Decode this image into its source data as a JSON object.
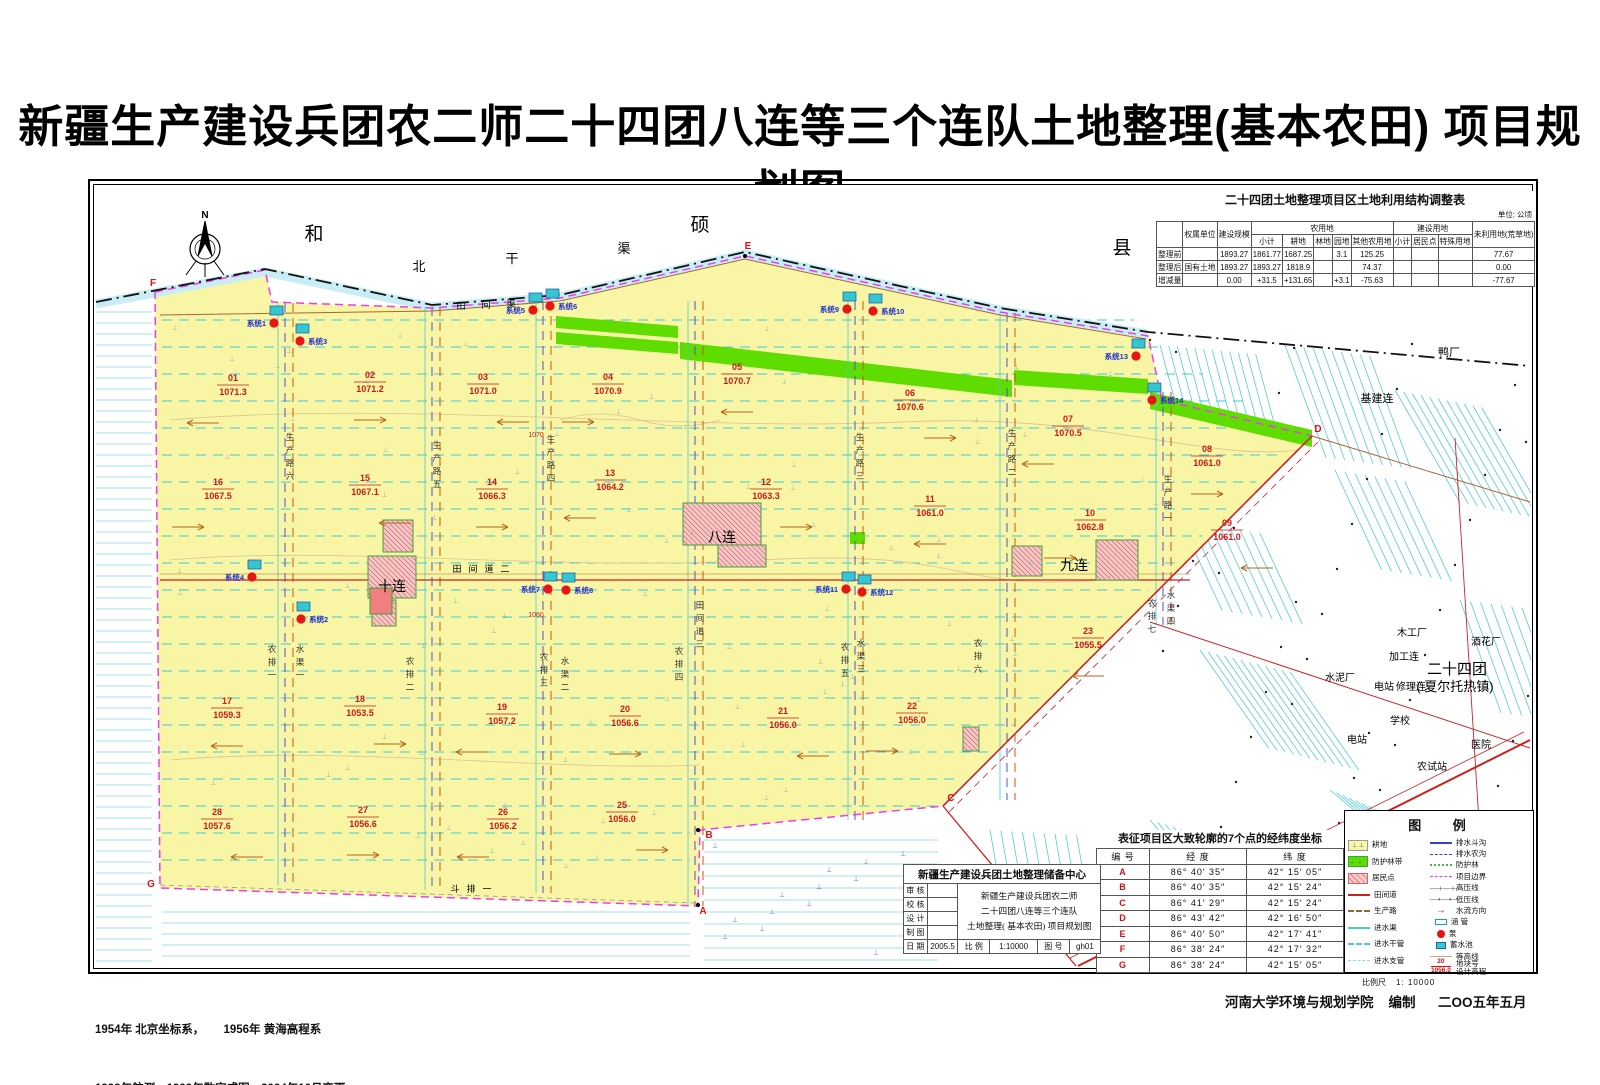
{
  "title": "新疆生产建设兵团农二师二十四团八连等三个连队土地整理(基本农田) 项目规划图",
  "adjustment_table": {
    "title": "二十四团土地整理项目区土地利用结构调整表",
    "unit": "单位: 公顷",
    "headers": {
      "row_label": "",
      "ownership": "权属单位",
      "scale": "建设规模",
      "agri": "农用地",
      "agri_sub": [
        "小计",
        "耕地",
        "林地",
        "园地",
        "其他农用地"
      ],
      "constr": "建设用地",
      "constr_sub": [
        "小计",
        "居民点",
        "特殊用地"
      ],
      "unused": "未利用地(荒草地)"
    },
    "rows": [
      {
        "label": "整理前",
        "ownership": "",
        "scale": "1893.27",
        "cells": [
          "1861.77",
          "1687.25",
          "",
          "3.1",
          "125.25",
          "",
          "",
          "",
          "77.67"
        ]
      },
      {
        "label": "整理后",
        "ownership": "国有土地",
        "scale": "1893.27",
        "cells": [
          "1893.27",
          "1818.9",
          "",
          "",
          "74.37",
          "",
          "",
          "",
          "0.00"
        ]
      },
      {
        "label": "增减量",
        "ownership": "",
        "scale": "0.00",
        "cells": [
          "+31.5",
          "+131.65",
          "",
          "+3.1",
          "-75.63",
          "",
          "",
          "",
          "-77.67"
        ]
      }
    ]
  },
  "coord_table": {
    "title": "表征项目区大致轮廓的7个点的经纬度坐标",
    "headers": [
      "编 号",
      "经 度",
      "纬 度"
    ],
    "rows": [
      [
        "A",
        "86° 40′ 35″",
        "42° 15′ 05″"
      ],
      [
        "B",
        "86° 40′ 35″",
        "42° 15′ 24″"
      ],
      [
        "C",
        "86° 41′ 29″",
        "42° 15′ 24″"
      ],
      [
        "D",
        "86° 43′ 42″",
        "42° 16′ 50″"
      ],
      [
        "E",
        "86° 40′ 50″",
        "42° 17′ 41″"
      ],
      [
        "F",
        "86° 38′ 24″",
        "42° 17′ 32″"
      ],
      [
        "G",
        "86° 38′ 24″",
        "42° 15′ 05″"
      ]
    ]
  },
  "title_block": {
    "org": "新疆生产建设兵团土地整理储备中心",
    "fields": [
      "审 核",
      "校 核",
      "设 计",
      "制 图"
    ],
    "date_label": "日 期",
    "date": "2005.5",
    "project": "新疆生产建设兵团农二师\n二十四团八连等三个连队\n土地整理( 基本农田) 项目规划图",
    "scale_label": "比 例",
    "scale": "1:10000",
    "fig_label": "图 号",
    "fig_no": "gh01"
  },
  "legend": {
    "title": "图 例",
    "left": [
      {
        "sym": "plot",
        "marks": "⊥ ⊥",
        "label": "耕地"
      },
      {
        "sym": "forest",
        "marks": "。 。",
        "label": "防护林带"
      },
      {
        "sym": "res",
        "label": "居民点"
      },
      {
        "sym": "line-red",
        "label": "田间道"
      },
      {
        "sym": "dash-brown",
        "label": "生产路"
      },
      {
        "sym": "line-cyan",
        "label": "进水渠"
      },
      {
        "sym": "dash-cyan",
        "label": "进水干管"
      },
      {
        "sym": "dash-cyan2",
        "label": "进水支管"
      }
    ],
    "right": [
      {
        "sym": "line-blue",
        "label": "排水斗沟"
      },
      {
        "sym": "dash-blue",
        "label": "排水农沟"
      },
      {
        "sym": "dot-green",
        "label": "防护林"
      },
      {
        "sym": "dash-magenta",
        "label": "项目边界"
      },
      {
        "sym": "text",
        "txt": "—+—+—",
        "label": "高压线"
      },
      {
        "sym": "text",
        "txt": "—•—•—",
        "label": "低压线"
      },
      {
        "sym": "arrow",
        "txt": "→",
        "label": "水流方向"
      },
      {
        "sym": "culvert",
        "label": "涵 管"
      },
      {
        "sym": "pump",
        "label": "泵"
      },
      {
        "sym": "pool",
        "label": "蓄水池"
      },
      {
        "sym": "contour",
        "label": "等高线"
      },
      {
        "sym": "plotno",
        "num": "20",
        "den": "1056.0",
        "label": "地块号\n设计高程"
      }
    ],
    "scale_label": "比例尺",
    "scale_value": "1: 10000"
  },
  "footer": {
    "line1": "1954年 北京坐标系，      1956年 黄海高程系",
    "line2": "1998年航测，1999年数字成图，2004年10月变更",
    "credit": "河南大学环境与规划学院    编制      二OO五年五月"
  },
  "map": {
    "compass_label": "N",
    "colors": {
      "plot_fill": "#F8F5A5",
      "forest_green": "#5FDC00",
      "boundary_magenta": "#E93EE9",
      "road_red": "#CC2020",
      "channel_cyan": "#49C9D9",
      "parcel_text_red": "#CC1818",
      "pump_red": "#E81515",
      "pool_cyan": "#35C6CF"
    },
    "parcels": [
      {
        "no": "01",
        "elev": "1071.3",
        "x": 233,
        "y": 383
      },
      {
        "no": "02",
        "elev": "1071.2",
        "x": 370,
        "y": 380
      },
      {
        "no": "03",
        "elev": "1071.0",
        "x": 483,
        "y": 382
      },
      {
        "no": "04",
        "elev": "1070.9",
        "x": 608,
        "y": 382
      },
      {
        "no": "05",
        "elev": "1070.7",
        "x": 737,
        "y": 372
      },
      {
        "no": "06",
        "elev": "1070.6",
        "x": 910,
        "y": 398
      },
      {
        "no": "07",
        "elev": "1070.5",
        "x": 1068,
        "y": 424
      },
      {
        "no": "08",
        "elev": "1061.0",
        "x": 1207,
        "y": 454
      },
      {
        "no": "09",
        "elev": "1061.0",
        "x": 1227,
        "y": 528
      },
      {
        "no": "10",
        "elev": "1062.8",
        "x": 1090,
        "y": 518
      },
      {
        "no": "11",
        "elev": "1061.0",
        "x": 930,
        "y": 504
      },
      {
        "no": "12",
        "elev": "1063.3",
        "x": 766,
        "y": 487
      },
      {
        "no": "13",
        "elev": "1064.2",
        "x": 610,
        "y": 478
      },
      {
        "no": "14",
        "elev": "1066.3",
        "x": 492,
        "y": 487
      },
      {
        "no": "15",
        "elev": "1067.1",
        "x": 365,
        "y": 483
      },
      {
        "no": "16",
        "elev": "1067.5",
        "x": 218,
        "y": 487
      },
      {
        "no": "17",
        "elev": "1059.3",
        "x": 227,
        "y": 706
      },
      {
        "no": "18",
        "elev": "1053.5",
        "x": 360,
        "y": 704
      },
      {
        "no": "19",
        "elev": "1057.2",
        "x": 502,
        "y": 712
      },
      {
        "no": "20",
        "elev": "1056.6",
        "x": 625,
        "y": 714
      },
      {
        "no": "21",
        "elev": "1056.0",
        "x": 783,
        "y": 716
      },
      {
        "no": "22",
        "elev": "1056.0",
        "x": 912,
        "y": 711
      },
      {
        "no": "23",
        "elev": "1055.5",
        "x": 1088,
        "y": 636
      },
      {
        "no": "25",
        "elev": "1056.0",
        "x": 622,
        "y": 810
      },
      {
        "no": "26",
        "elev": "1056.2",
        "x": 503,
        "y": 817
      },
      {
        "no": "27",
        "elev": "1056.6",
        "x": 363,
        "y": 815
      },
      {
        "no": "28",
        "elev": "1057.6",
        "x": 217,
        "y": 817
      }
    ],
    "systems": [
      {
        "label": "系统1",
        "x": 274,
        "y": 323,
        "side": "l"
      },
      {
        "label": "系统3",
        "x": 300,
        "y": 341,
        "side": "r"
      },
      {
        "label": "系统5",
        "x": 533,
        "y": 310,
        "side": "l"
      },
      {
        "label": "系统6",
        "x": 550,
        "y": 306,
        "side": "r"
      },
      {
        "label": "系统9",
        "x": 847,
        "y": 309,
        "side": "l"
      },
      {
        "label": "系统10",
        "x": 873,
        "y": 311,
        "side": "r"
      },
      {
        "label": "系统13",
        "x": 1136,
        "y": 356,
        "side": "l"
      },
      {
        "label": "系统14",
        "x": 1152,
        "y": 400,
        "side": "r"
      },
      {
        "label": "系统4",
        "x": 252,
        "y": 577,
        "side": "l"
      },
      {
        "label": "系统2",
        "x": 301,
        "y": 619,
        "side": "r"
      },
      {
        "label": "系统7",
        "x": 548,
        "y": 589,
        "side": "l"
      },
      {
        "label": "系统8",
        "x": 566,
        "y": 590,
        "side": "r"
      },
      {
        "label": "系统11",
        "x": 846,
        "y": 589,
        "side": "l"
      },
      {
        "label": "系统12",
        "x": 862,
        "y": 592,
        "side": "r"
      }
    ],
    "road_labels": [
      {
        "text": "生产路六",
        "x": 290,
        "y": 440
      },
      {
        "text": "生产路五",
        "x": 437,
        "y": 448
      },
      {
        "text": "生产路四",
        "x": 551,
        "y": 442
      },
      {
        "text": "生产路三",
        "x": 860,
        "y": 440
      },
      {
        "text": "生产路二",
        "x": 1012,
        "y": 436
      },
      {
        "text": "生产路一",
        "x": 1168,
        "y": 482
      },
      {
        "text": "田间道三",
        "x": 700,
        "y": 608
      },
      {
        "text": "农排一",
        "x": 272,
        "y": 652
      },
      {
        "text": "水渠一",
        "x": 300,
        "y": 652
      },
      {
        "text": "农排二",
        "x": 410,
        "y": 664
      },
      {
        "text": "农排三",
        "x": 544,
        "y": 660
      },
      {
        "text": "水渠二",
        "x": 565,
        "y": 664
      },
      {
        "text": "农排四",
        "x": 679,
        "y": 654
      },
      {
        "text": "农排五",
        "x": 845,
        "y": 650
      },
      {
        "text": "水渠三",
        "x": 861,
        "y": 646
      },
      {
        "text": "农排六",
        "x": 978,
        "y": 646
      },
      {
        "text": "农排七",
        "x": 1152,
        "y": 606
      },
      {
        "text": "水渠四",
        "x": 1171,
        "y": 598
      }
    ],
    "texts": [
      {
        "t": "和",
        "x": 314,
        "y": 240,
        "s": 19
      },
      {
        "t": "硕",
        "x": 700,
        "y": 231,
        "s": 19
      },
      {
        "t": "县",
        "x": 1122,
        "y": 254,
        "s": 19
      },
      {
        "t": "北",
        "x": 419,
        "y": 271,
        "s": 13
      },
      {
        "t": "干",
        "x": 512,
        "y": 263,
        "s": 13
      },
      {
        "t": "渠",
        "x": 624,
        "y": 253,
        "s": 13
      },
      {
        "t": "田",
        "x": 461,
        "y": 309,
        "s": 9
      },
      {
        "t": "间",
        "x": 486,
        "y": 308,
        "s": 9
      },
      {
        "t": "渠",
        "x": 511,
        "y": 307,
        "s": 9
      },
      {
        "t": "田",
        "x": 457,
        "y": 572,
        "s": 9
      },
      {
        "t": "间",
        "x": 473,
        "y": 572,
        "s": 9
      },
      {
        "t": "道",
        "x": 489,
        "y": 572,
        "s": 9
      },
      {
        "t": "二",
        "x": 505,
        "y": 572,
        "s": 9
      },
      {
        "t": "斗",
        "x": 455,
        "y": 892,
        "s": 9
      },
      {
        "t": "排",
        "x": 471,
        "y": 892,
        "s": 9
      },
      {
        "t": "一",
        "x": 487,
        "y": 892,
        "s": 9
      },
      {
        "t": "十连",
        "x": 392,
        "y": 591,
        "s": 14
      },
      {
        "t": "八连",
        "x": 722,
        "y": 542,
        "s": 14
      },
      {
        "t": "九连",
        "x": 1074,
        "y": 570,
        "s": 14
      },
      {
        "t": "基建连",
        "x": 1377,
        "y": 402,
        "s": 11
      },
      {
        "t": "鸭厂",
        "x": 1449,
        "y": 356,
        "s": 11
      },
      {
        "t": "木工厂",
        "x": 1412,
        "y": 636,
        "s": 10
      },
      {
        "t": "酒花厂",
        "x": 1486,
        "y": 645,
        "s": 10
      },
      {
        "t": "加工连",
        "x": 1404,
        "y": 660,
        "s": 10
      },
      {
        "t": "二十四团",
        "x": 1457,
        "y": 674,
        "s": 15
      },
      {
        "t": "( 夏尔托热镇)",
        "x": 1455,
        "y": 691,
        "s": 13
      },
      {
        "t": "水泥厂",
        "x": 1340,
        "y": 681,
        "s": 10
      },
      {
        "t": "电站",
        "x": 1384,
        "y": 690,
        "s": 10
      },
      {
        "t": "修理连",
        "x": 1411,
        "y": 690,
        "s": 10
      },
      {
        "t": "学校",
        "x": 1400,
        "y": 724,
        "s": 10
      },
      {
        "t": "电站",
        "x": 1357,
        "y": 743,
        "s": 10
      },
      {
        "t": "医院",
        "x": 1481,
        "y": 748,
        "s": 10
      },
      {
        "t": "农试站",
        "x": 1432,
        "y": 770,
        "s": 10
      },
      {
        "t": "1070",
        "x": 536,
        "y": 437,
        "s": 7,
        "c": "#cc2020"
      },
      {
        "t": "1060",
        "x": 536,
        "y": 617,
        "s": 7,
        "c": "#cc2020"
      },
      {
        "t": "N",
        "x": 205,
        "y": 218,
        "s": 10,
        "w": 700
      }
    ],
    "corners": [
      {
        "t": "A",
        "x": 703,
        "y": 914
      },
      {
        "t": "B",
        "x": 709,
        "y": 838
      },
      {
        "t": "C",
        "x": 951,
        "y": 801
      },
      {
        "t": "D",
        "x": 1318,
        "y": 432
      },
      {
        "t": "E",
        "x": 748,
        "y": 249
      },
      {
        "t": "F",
        "x": 153,
        "y": 286
      },
      {
        "t": "G",
        "x": 151,
        "y": 887
      }
    ]
  }
}
